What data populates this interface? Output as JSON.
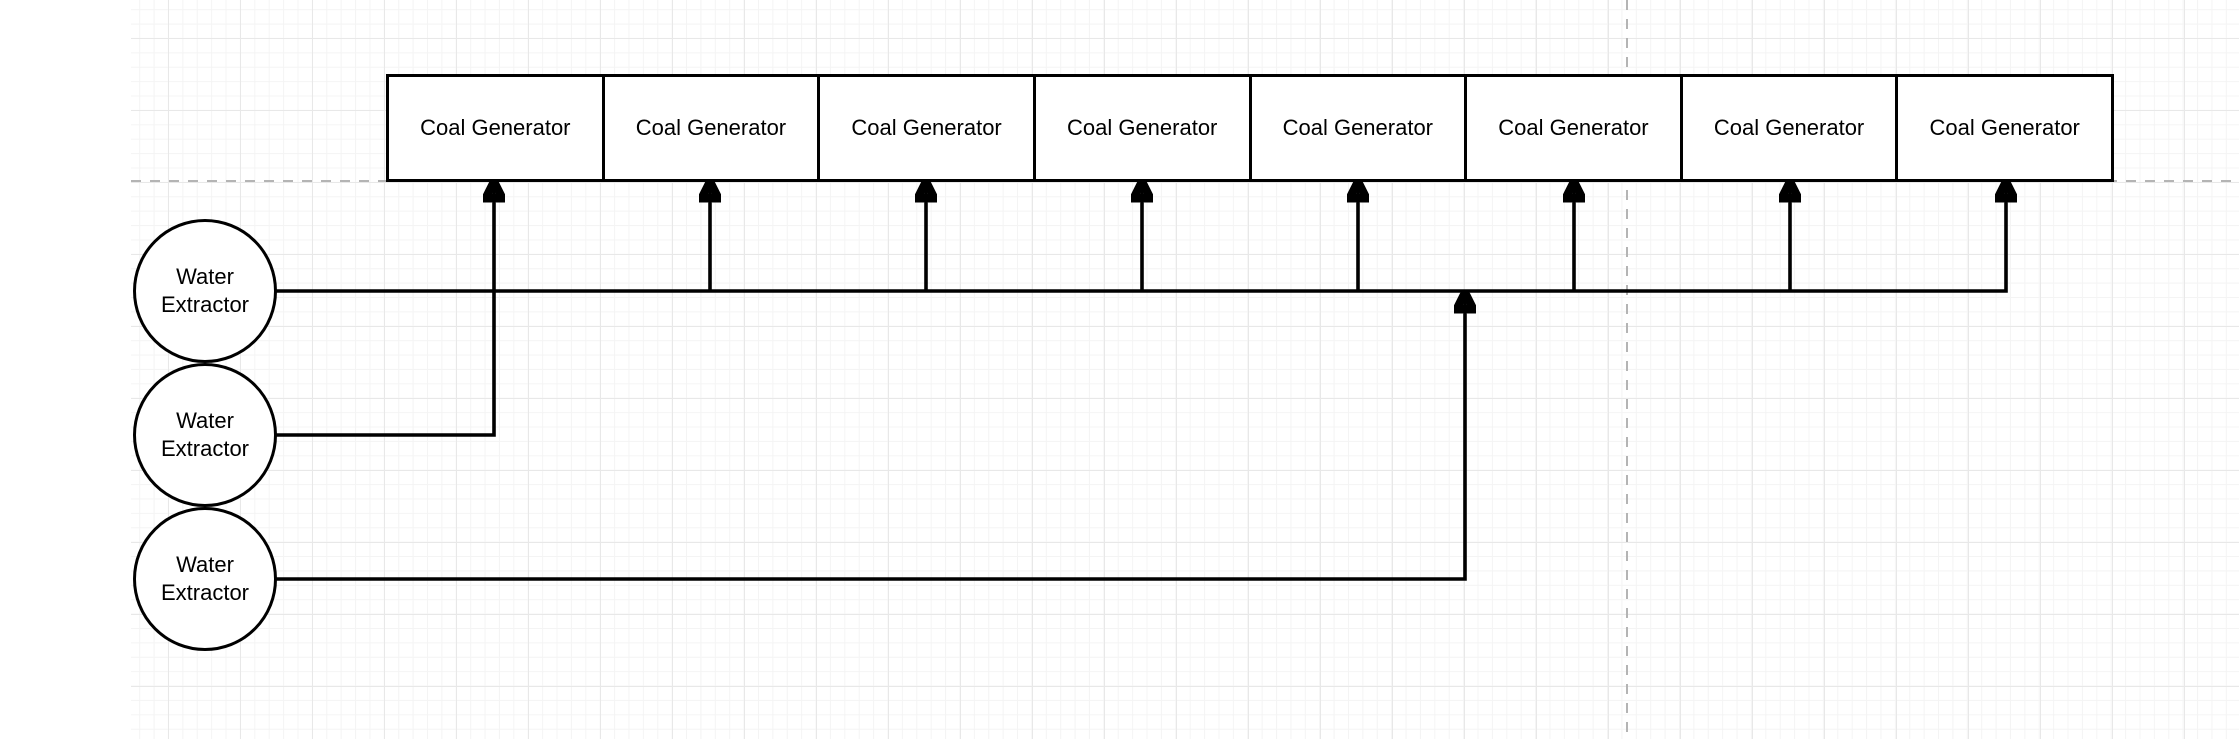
{
  "diagram": {
    "nodes": {
      "coal_generators": [
        {
          "label": "Coal Generator"
        },
        {
          "label": "Coal Generator"
        },
        {
          "label": "Coal Generator"
        },
        {
          "label": "Coal Generator"
        },
        {
          "label": "Coal Generator"
        },
        {
          "label": "Coal Generator"
        },
        {
          "label": "Coal Generator"
        },
        {
          "label": "Coal Generator"
        }
      ],
      "water_extractors": [
        {
          "label": "Water Extractor"
        },
        {
          "label": "Water Extractor"
        },
        {
          "label": "Water Extractor"
        }
      ]
    },
    "edges": [
      {
        "from": "water-extractor-1",
        "to": "coal-generator-2",
        "style": "orthogonal-arrow"
      },
      {
        "from": "water-extractor-1",
        "to": "coal-generator-3",
        "style": "orthogonal-arrow"
      },
      {
        "from": "water-extractor-1",
        "to": "coal-generator-4",
        "style": "orthogonal-arrow"
      },
      {
        "from": "water-extractor-1",
        "to": "coal-generator-5",
        "style": "orthogonal-arrow"
      },
      {
        "from": "water-extractor-1",
        "to": "coal-generator-6",
        "style": "orthogonal-arrow"
      },
      {
        "from": "water-extractor-1",
        "to": "coal-generator-7",
        "style": "orthogonal-arrow"
      },
      {
        "from": "water-extractor-1",
        "to": "coal-generator-8",
        "style": "orthogonal-arrow"
      },
      {
        "from": "water-extractor-2",
        "to": "coal-generator-1",
        "style": "orthogonal-arrow"
      },
      {
        "from": "water-extractor-3",
        "to": "water-extractor-1-bus-line",
        "style": "orthogonal-arrow"
      }
    ],
    "colors": {
      "node_stroke": "#000000",
      "node_fill": "#ffffff",
      "connector": "#000000",
      "text": "#000000",
      "page_border_dash": "#b4b4b4",
      "grid_major": "#e8e8e8",
      "grid_minor": "#f4f4f4",
      "canvas_background": "#ffffff"
    }
  }
}
